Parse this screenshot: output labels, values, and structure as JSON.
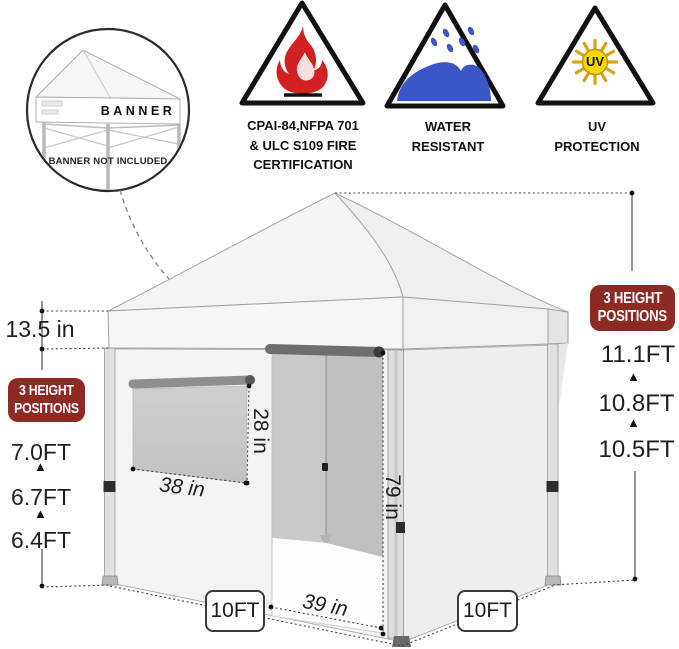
{
  "inset": {
    "banner_label": "BANNER",
    "note": "BANNER NOT INCLUDED"
  },
  "certifications": {
    "fire": {
      "line1": "CPAI-84,NFPA 701",
      "line2": "& ULC S109 FIRE",
      "line3": "CERTIFICATION"
    },
    "water": {
      "line1": "WATER",
      "line2": "RESISTANT"
    },
    "uv": {
      "line1": "UV",
      "line2": "PROTECTION",
      "sun_label": "UV"
    }
  },
  "height_badge": {
    "line1": "3 HEIGHT",
    "line2": "POSITIONS"
  },
  "left_heights": {
    "h1": "7.0FT",
    "h2": "6.7FT",
    "h3": "6.4FT"
  },
  "right_heights": {
    "h1": "11.1FT",
    "h2": "10.8FT",
    "h3": "10.5FT"
  },
  "measurements": {
    "valance": "13.5 in",
    "window_w": "38 in",
    "window_h": "28 in",
    "door_h": "79 in",
    "door_w": "39 in",
    "base_left": "10FT",
    "base_right": "10FT"
  },
  "symbols": {
    "up_arrow": "▲"
  },
  "colors": {
    "badge_red": "#8e2a24",
    "flame_red": "#d32121",
    "water_blue": "#3a57c8",
    "sun_yellow": "#f5d70a"
  }
}
